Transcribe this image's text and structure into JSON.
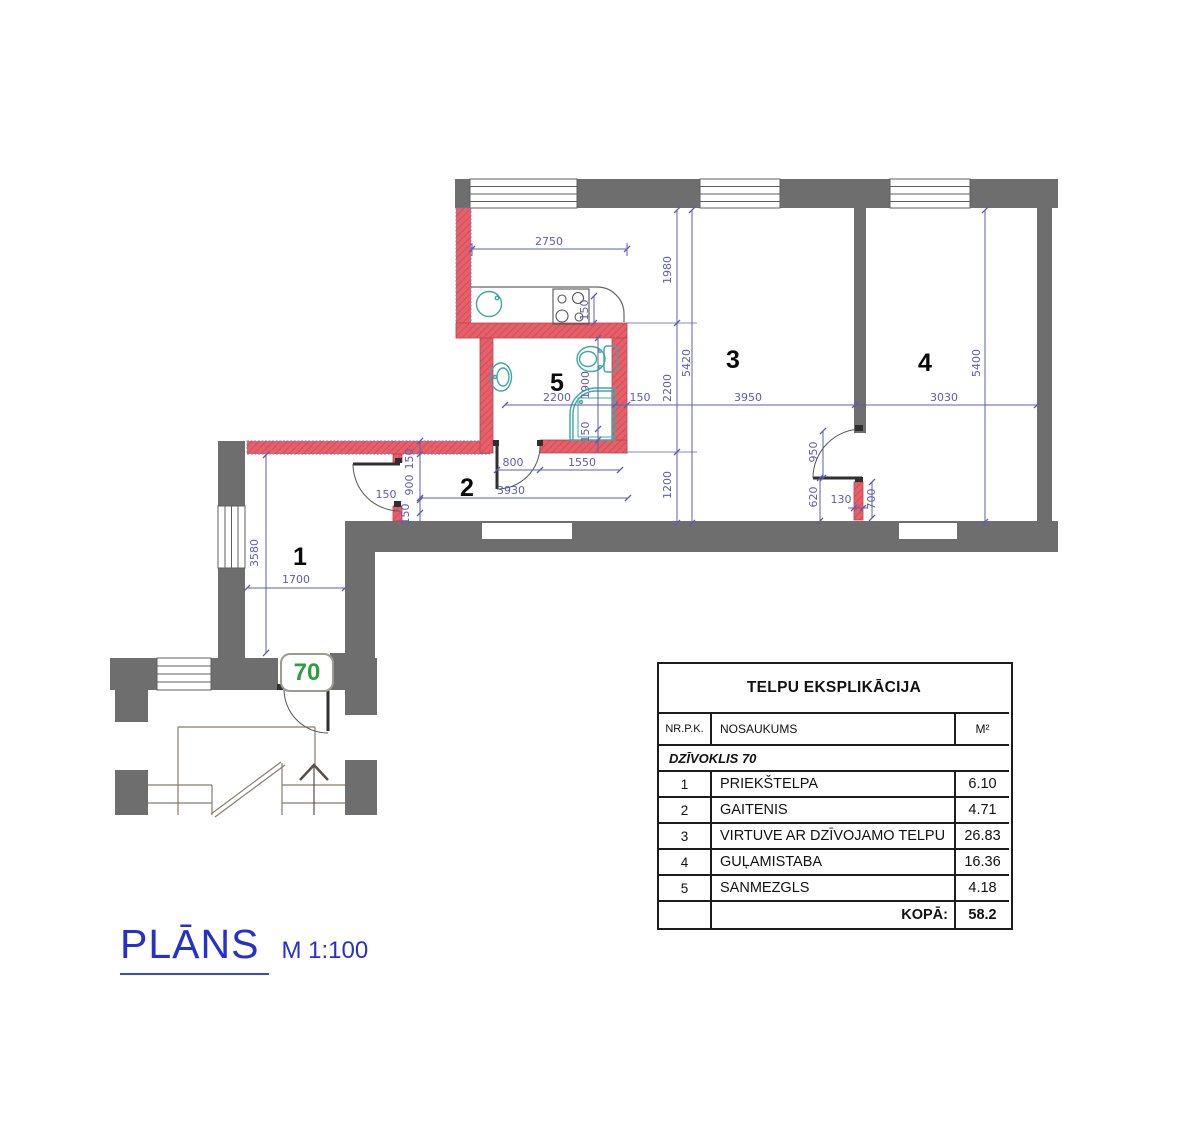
{
  "title_block": {
    "title": "PLĀNS",
    "scale": "M 1:100"
  },
  "apartment_badge": {
    "number": "70"
  },
  "plan": {
    "rooms": [
      {
        "number": "1",
        "name": "PRIEKŠTELPA"
      },
      {
        "number": "2",
        "name": "GAITENIS"
      },
      {
        "number": "3",
        "name": "VIRTUVE AR DZĪVOJAMO TELPU"
      },
      {
        "number": "4",
        "name": "GUĻAMISTABA"
      },
      {
        "number": "5",
        "name": "SANMEZGLS"
      }
    ],
    "dimensions": [
      {
        "label": "2750"
      },
      {
        "label": "1980"
      },
      {
        "label": "5420"
      },
      {
        "label": "2200"
      },
      {
        "label": "1200"
      },
      {
        "label": "3950"
      },
      {
        "label": "3030"
      },
      {
        "label": "5400"
      },
      {
        "label": "150"
      },
      {
        "label": "2200"
      },
      {
        "label": "1900"
      },
      {
        "label": "150"
      },
      {
        "label": "150"
      },
      {
        "label": "800"
      },
      {
        "label": "1550"
      },
      {
        "label": "3930"
      },
      {
        "label": "150"
      },
      {
        "label": "900"
      },
      {
        "label": "150"
      },
      {
        "label": "150"
      },
      {
        "label": "3580"
      },
      {
        "label": "1700"
      },
      {
        "label": "950"
      },
      {
        "label": "620"
      },
      {
        "label": "130"
      },
      {
        "label": "700"
      }
    ]
  },
  "table": {
    "title": "TELPU EKSPLIKĀCIJA",
    "columns": {
      "nr": "NR.P.K.",
      "name": "NOSAUKUMS",
      "area": "M²"
    },
    "group_row": "DZĪVOKLIS 70",
    "rows": [
      {
        "nr": "1",
        "name": "PRIEKŠTELPA",
        "area": "6.10"
      },
      {
        "nr": "2",
        "name": "GAITENIS",
        "area": "4.71"
      },
      {
        "nr": "3",
        "name": "VIRTUVE AR DZĪVOJAMO TELPU",
        "area": "26.83"
      },
      {
        "nr": "4",
        "name": "GUĻAMISTABA",
        "area": "16.36"
      },
      {
        "nr": "5",
        "name": "SANMEZGLS",
        "area": "4.18"
      }
    ],
    "total_label": "KOPĀ:",
    "total_value": "58.2"
  },
  "colors": {
    "wall_existing": "#6e6e6e",
    "wall_new_red": "#e65f69",
    "fixture_teal": "#3fa8a2",
    "dimension_blue": "#5c5cb5",
    "title_blue": "#2531c8",
    "badge_green": "#2d9e3d"
  }
}
